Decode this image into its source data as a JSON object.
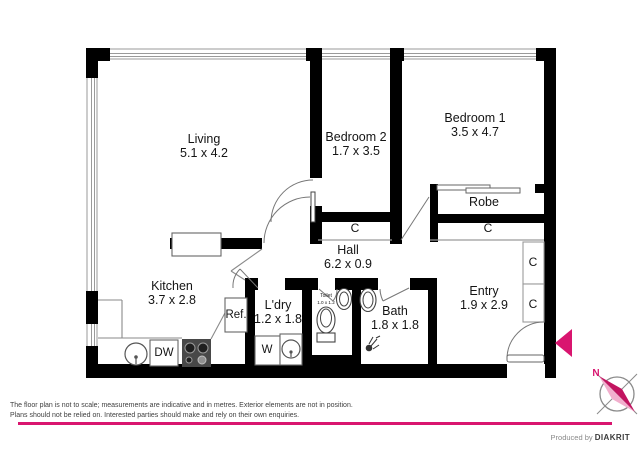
{
  "colors": {
    "wall": "#000000",
    "accent_pink": "#d9156f",
    "needle_dark": "#c21460",
    "needle_light": "#f2afcd"
  },
  "rooms": {
    "living": {
      "name": "Living",
      "dims": "5.1 x 4.2"
    },
    "bedroom2": {
      "name": "Bedroom 2",
      "dims": "1.7 x 3.5"
    },
    "bedroom1": {
      "name": "Bedroom 1",
      "dims": "3.5 x 4.7"
    },
    "robe": {
      "name": "Robe"
    },
    "hall": {
      "name": "Hall",
      "dims": "6.2 x 0.9"
    },
    "kitchen": {
      "name": "Kitchen",
      "dims": "3.7 x 2.8"
    },
    "laundry": {
      "name": "L'dry",
      "dims": "1.2 x 1.8"
    },
    "toilet": {
      "name": "Toilet",
      "dims": "1.0 x 1.2"
    },
    "bath": {
      "name": "Bath",
      "dims": "1.8 x 1.8"
    },
    "entry": {
      "name": "Entry",
      "dims": "1.9 x 2.9"
    }
  },
  "closets": {
    "hall_c": "C",
    "robe_c": "C",
    "entry_c_top": "C",
    "entry_c_bottom": "C"
  },
  "appliances": {
    "fridge": "Ref.",
    "dishwasher": "DW",
    "washer": "W"
  },
  "compass": {
    "north": "N"
  },
  "footer": {
    "disclaimer_line1": "The floor plan is not to scale; measurements are indicative and in metres. Exterior elements are not in position.",
    "disclaimer_line2": "Plans should not be relied on. Interested parties should make and rely on their own enquiries.",
    "produced_by": "Produced by",
    "brand": "DIAKRIT"
  }
}
